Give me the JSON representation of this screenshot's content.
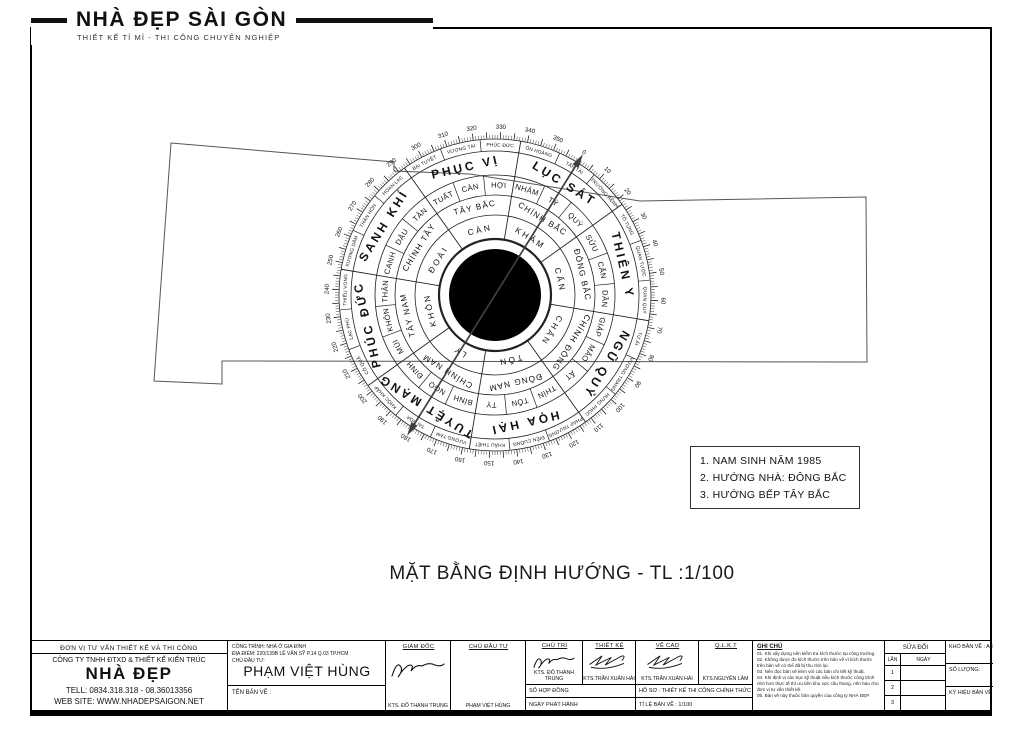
{
  "logo": {
    "title": "NHÀ ĐẸP SÀI GÒN",
    "tagline": "THIẾT KẾ TỈ MỈ - THI CÔNG CHUYÊN NGHIỆP"
  },
  "drawing_title": "MẶT BẰNG ĐỊNH HƯỚNG - TL :1/100",
  "notes_box": {
    "items": [
      "1. NAM SINH NĂM 1985",
      "2. HƯỚNG NHÀ: ĐÔNG BẮC",
      "3. HƯỚNG BẾP TÂY BẮC"
    ]
  },
  "floor_plan": {
    "points": "171,143 394,162 394,171 470,174 640,201 866,197 867,362 222,361 222,384 154,381"
  },
  "compass": {
    "rotation_deg": 32,
    "bat_trach": [
      "LỤC SÁT",
      "THIÊN Y",
      "NGŨ QUỶ",
      "HỌA HẠI",
      "TUYỆT MẠNG",
      "PHÚC ĐỨC",
      "SANH KHÍ",
      "PHỤC VỊ"
    ],
    "directions": [
      "CHÍNH BẮC",
      "ĐÔNG BẮC",
      "CHÍNH ĐÔNG",
      "ĐÔNG NAM",
      "CHÍNH NAM",
      "TÂY NAM",
      "CHÍNH TÂY",
      "TÂY BẮC"
    ],
    "trigrams": [
      "KHẢM",
      "CẤN",
      "CHẤN",
      "TỐN",
      "LY",
      "KHÔN",
      "ĐOÀI",
      "CÀN"
    ],
    "mountains": [
      "TÝ",
      "QUÝ",
      "SỬU",
      "CẤN",
      "DẦN",
      "GIÁP",
      "MÃO",
      "ẤT",
      "THÌN",
      "TỐN",
      "TỴ",
      "BÍNH",
      "NGỌ",
      "ĐINH",
      "MÙI",
      "KHÔN",
      "THÂN",
      "CANH",
      "DẬU",
      "TÂN",
      "TUẤT",
      "CÀN",
      "HỢI",
      "NHÂM"
    ],
    "phuc_duc": [
      "TẤN TÀI",
      "TRƯỜNG BỆNH",
      "TỐ TỤNG",
      "QUAN TƯỚC",
      "QUAN QUÝ",
      "TỰ ẢI",
      "VƯỢNG TRANG",
      "HƯNG PHÚC",
      "PHÁP TRƯỜNG",
      "ĐIÊN CUỒNG",
      "KHẨU THIỆT",
      "VƯỢNG TÀM",
      "TAI HỌA",
      "KHỐC KHẤP",
      "CÔ QUẢ",
      "LẠC PHÚ",
      "THIẾU VONG",
      "XƯƠNG DÂM",
      "THÂN HÔN",
      "HOAN LẠC",
      "BẠI TUYỆT",
      "VƯỢNG TÀI",
      "PHÚC ĐỨC",
      "ÔN HOÀNG"
    ],
    "degree_step": 10
  },
  "title_block": {
    "company": {
      "header": "ĐƠN VỊ TƯ VẤN THIẾT KẾ VÀ THI CÔNG",
      "line1": "CÔNG TY TNHH ĐTXD & THIẾT KẾ KIẾN TRÚC",
      "name": "NHÀ ĐẸP",
      "tel": "TELL: 0834.318.318  -  08.36013356",
      "web": "WEB SITE: WWW.NHADEPSAIGON.NET"
    },
    "project": {
      "cong_trinh": "CÔNG TRÌNH: NHÀ Ở GIA ĐÌNH",
      "dia_diem": "ĐỊA ĐIỂM: 220/139B LÊ VĂN SỸ P.14 Q.03 TP.HCM",
      "chu_label": "CHỦ ĐẦU TƯ:",
      "chu_name": "PHẠM VIỆT HÙNG",
      "ten_ban_ve": "TÊN BẢN VẼ :"
    },
    "sign_cols": [
      {
        "role": "GIÁM ĐỐC",
        "name": "KTS. ĐỖ THÀNH TRUNG"
      },
      {
        "role": "CHỦ ĐẦU TƯ",
        "name": "PHẠM VIỆT HÙNG"
      },
      {
        "role": "CHỦ TRÌ",
        "name": "KTS. ĐỖ THÀNH TRUNG"
      },
      {
        "role": "THIẾT KẾ",
        "name": "KTS.TRẦN XUÂN HẢI"
      },
      {
        "role": "VẼ CAD",
        "name": "KTS.TRẦN XUÂN HẢI"
      },
      {
        "role": "Q.L.K.T",
        "name": "KTS.NGUYỄN LÂM"
      }
    ],
    "rows": {
      "so_hop_dong": "SỐ HỢP ĐỒNG",
      "ho_so": "HỒ SƠ : THIẾT KẾ THI CÔNG CHÍNH THỨC",
      "ngay_phat_hanh": "NGÀY PHÁT HÀNH",
      "ti_le": "TỈ LỆ BẢN VẼ : 1/100"
    },
    "ghi_chu": {
      "title": "GHI CHÚ",
      "notes": [
        "01. Khi xây dựng nên kiểm tra kích thước tại công trường.",
        "02. Không được đo kích thước trên bản vẽ vì kích thước trên bản vẽ có thể đã bị thu nhỏ lại.",
        "03. Nên đọc bản vẽ kèm với các bản chi tiết kỹ thuật.",
        "04. Khi định vị các trục kỹ thuật nếu kích thước công trình nhỏ hơn thực tế thì ưu tiên khu vực cầu thang, nên báo cho đơn vị tư vấn thiết kế.",
        "05. Bản vẽ này thuộc bản quyền của công ty NHÀ ĐẸP."
      ]
    },
    "sua_doi": {
      "title": "SỬA ĐỔI",
      "lan": "LẦN",
      "ngay": "NGÀY",
      "rows": [
        "1",
        "2",
        "3"
      ]
    },
    "info": {
      "kho": "KHỔ BẢN VẼ : A3",
      "so_luong": "SỐ LƯỢNG:",
      "ky_hieu": "KÝ HIỆU BẢN VẼ"
    }
  },
  "colors": {
    "ink": "#111111",
    "line": "#222222",
    "plan_line": "#555555",
    "arrow": "#3f3f3f"
  }
}
